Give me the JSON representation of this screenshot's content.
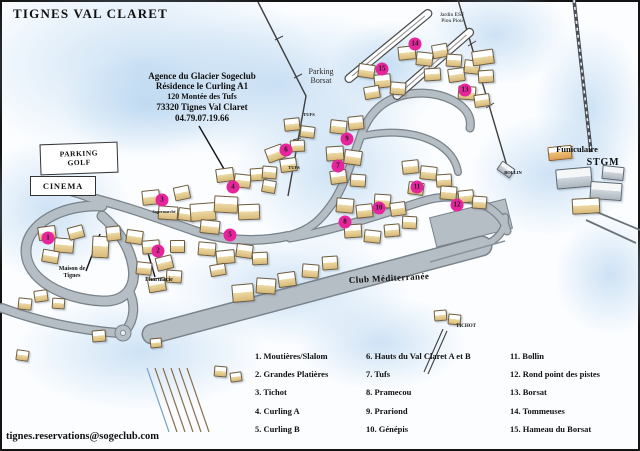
{
  "title": "TIGNES VAL CLARET",
  "agency": {
    "lines": [
      "Agence du Glacier Sogeclub",
      "Résidence le Curling A1",
      "120 Montée des Tufs",
      "73320 Tignes Val Claret",
      "04.79.07.19.66"
    ]
  },
  "contact_email": "tignes.reservations@sogeclub.com",
  "map_labels": {
    "parking_golf": [
      "PARKING",
      "GOLF"
    ],
    "cinema": "CINEMA",
    "parking_borsat": [
      "Parking",
      "Borsat"
    ],
    "jardin_esf": [
      "Jardin ESF",
      "Piou Piou"
    ],
    "funiculaire": "Funiculaire",
    "stgm": "STGM",
    "bollin": "BOLLIN",
    "club_mediterranee": "Club Méditerranée",
    "tichot": "TICHOT",
    "tufs": "TUFS",
    "maison_de_tignes": [
      "Maison de",
      "Tignes"
    ],
    "pharmacie": "Pharmacie",
    "supermarche": "Supermarché"
  },
  "legend": {
    "columns": [
      [
        "1. Moutières/Slalom",
        "2. Grandes Platières",
        "3. Tichot",
        "4. Curling A",
        "5. Curling B"
      ],
      [
        "6. Hauts du Val Claret A et B",
        "7. Tufs",
        "8. Pramecou",
        "9. Prariond",
        "10. Génépis"
      ],
      [
        "11. Bollin",
        "12. Rond point des pistes",
        "13. Borsat",
        "14. Tommeuses",
        "15. Hameau du Borsat"
      ]
    ]
  },
  "markers": [
    {
      "n": "1",
      "x": 48,
      "y": 238
    },
    {
      "n": "2",
      "x": 158,
      "y": 251
    },
    {
      "n": "3",
      "x": 162,
      "y": 200
    },
    {
      "n": "4",
      "x": 233,
      "y": 187
    },
    {
      "n": "5",
      "x": 230,
      "y": 235
    },
    {
      "n": "6",
      "x": 286,
      "y": 150
    },
    {
      "n": "7",
      "x": 338,
      "y": 166
    },
    {
      "n": "8",
      "x": 345,
      "y": 222
    },
    {
      "n": "9",
      "x": 347,
      "y": 139
    },
    {
      "n": "10",
      "x": 379,
      "y": 208
    },
    {
      "n": "11",
      "x": 417,
      "y": 187
    },
    {
      "n": "12",
      "x": 457,
      "y": 205
    },
    {
      "n": "13",
      "x": 465,
      "y": 90
    },
    {
      "n": "14",
      "x": 415,
      "y": 44
    },
    {
      "n": "15",
      "x": 382,
      "y": 69
    }
  ],
  "colors": {
    "marker_pink": "#e6259c",
    "road_gray": "#b6bec5",
    "road_edge": "#79828a",
    "snow_blue": "#a8ccec",
    "ink": "#141414"
  },
  "decor": {
    "snow_patches": [
      [
        -40,
        -30,
        360,
        190
      ],
      [
        120,
        10,
        320,
        150
      ],
      [
        235,
        85,
        200,
        170
      ],
      [
        420,
        -15,
        150,
        100
      ],
      [
        535,
        25,
        110,
        170
      ],
      [
        -30,
        140,
        160,
        140
      ],
      [
        170,
        235,
        240,
        110
      ],
      [
        470,
        115,
        160,
        120
      ],
      [
        15,
        295,
        250,
        115
      ],
      [
        295,
        295,
        170,
        95
      ],
      [
        555,
        215,
        110,
        120
      ],
      [
        60,
        55,
        170,
        100
      ],
      [
        330,
        20,
        120,
        90
      ]
    ],
    "buildings": [
      [
        38,
        226,
        16,
        12,
        -8
      ],
      [
        54,
        238,
        18,
        13,
        5
      ],
      [
        68,
        226,
        14,
        11,
        -15
      ],
      [
        42,
        250,
        15,
        11,
        10
      ],
      [
        92,
        236,
        15,
        20,
        3
      ],
      [
        106,
        226,
        13,
        13,
        -6
      ],
      [
        126,
        230,
        15,
        12,
        8
      ],
      [
        142,
        240,
        16,
        12,
        -5
      ],
      [
        156,
        256,
        15,
        12,
        -14
      ],
      [
        136,
        262,
        14,
        11,
        6
      ],
      [
        170,
        240,
        13,
        11,
        0
      ],
      [
        148,
        278,
        16,
        12,
        -10
      ],
      [
        166,
        270,
        14,
        11,
        4
      ],
      [
        142,
        190,
        16,
        13,
        -6
      ],
      [
        158,
        206,
        18,
        12,
        4
      ],
      [
        174,
        186,
        14,
        12,
        -12
      ],
      [
        178,
        208,
        14,
        11,
        8
      ],
      [
        190,
        203,
        24,
        16,
        -4
      ],
      [
        214,
        196,
        22,
        15,
        3
      ],
      [
        238,
        204,
        20,
        14,
        -2
      ],
      [
        200,
        220,
        18,
        12,
        6
      ],
      [
        216,
        168,
        16,
        12,
        -8
      ],
      [
        234,
        174,
        15,
        12,
        6
      ],
      [
        250,
        168,
        14,
        11,
        -4
      ],
      [
        262,
        180,
        12,
        11,
        10
      ],
      [
        198,
        242,
        16,
        12,
        5
      ],
      [
        216,
        250,
        17,
        12,
        -6
      ],
      [
        236,
        244,
        15,
        12,
        8
      ],
      [
        252,
        252,
        14,
        11,
        -3
      ],
      [
        210,
        264,
        14,
        10,
        -10
      ],
      [
        232,
        284,
        20,
        16,
        -5
      ],
      [
        256,
        278,
        18,
        14,
        4
      ],
      [
        278,
        272,
        16,
        13,
        -8
      ],
      [
        302,
        264,
        15,
        12,
        5
      ],
      [
        322,
        256,
        14,
        12,
        -4
      ],
      [
        18,
        298,
        12,
        10,
        6
      ],
      [
        34,
        290,
        12,
        10,
        -8
      ],
      [
        52,
        298,
        11,
        9,
        4
      ],
      [
        92,
        330,
        12,
        10,
        -5
      ],
      [
        16,
        350,
        11,
        9,
        8
      ],
      [
        150,
        338,
        10,
        8,
        -6
      ],
      [
        214,
        366,
        11,
        9,
        5
      ],
      [
        230,
        372,
        10,
        8,
        -8
      ],
      [
        266,
        146,
        16,
        13,
        -20
      ],
      [
        280,
        158,
        15,
        12,
        -8
      ],
      [
        262,
        166,
        13,
        11,
        5
      ],
      [
        284,
        118,
        14,
        11,
        -6
      ],
      [
        300,
        126,
        13,
        10,
        7
      ],
      [
        290,
        140,
        13,
        10,
        -3
      ],
      [
        330,
        120,
        15,
        12,
        6
      ],
      [
        348,
        116,
        14,
        12,
        -6
      ],
      [
        326,
        146,
        16,
        13,
        -4
      ],
      [
        344,
        150,
        16,
        13,
        8
      ],
      [
        330,
        170,
        15,
        12,
        -8
      ],
      [
        350,
        174,
        14,
        11,
        4
      ],
      [
        336,
        198,
        16,
        13,
        5
      ],
      [
        356,
        204,
        15,
        12,
        -6
      ],
      [
        374,
        194,
        15,
        12,
        4
      ],
      [
        390,
        202,
        14,
        12,
        -8
      ],
      [
        344,
        224,
        16,
        12,
        -4
      ],
      [
        364,
        230,
        15,
        11,
        6
      ],
      [
        384,
        224,
        14,
        11,
        -5
      ],
      [
        402,
        216,
        13,
        11,
        3
      ],
      [
        402,
        160,
        15,
        12,
        -6
      ],
      [
        420,
        166,
        15,
        12,
        6
      ],
      [
        436,
        174,
        14,
        11,
        -4
      ],
      [
        408,
        182,
        14,
        11,
        8
      ],
      [
        440,
        186,
        15,
        12,
        5
      ],
      [
        458,
        190,
        14,
        11,
        -6
      ],
      [
        472,
        196,
        13,
        11,
        4
      ],
      [
        448,
        68,
        15,
        12,
        -8
      ],
      [
        464,
        60,
        14,
        12,
        6
      ],
      [
        478,
        70,
        14,
        11,
        -4
      ],
      [
        458,
        86,
        16,
        12,
        4
      ],
      [
        474,
        94,
        14,
        11,
        -8
      ],
      [
        398,
        46,
        16,
        12,
        -6
      ],
      [
        416,
        52,
        15,
        12,
        6
      ],
      [
        432,
        44,
        14,
        12,
        -10
      ],
      [
        446,
        54,
        14,
        11,
        4
      ],
      [
        424,
        68,
        15,
        11,
        -4
      ],
      [
        358,
        64,
        15,
        12,
        8
      ],
      [
        374,
        74,
        15,
        12,
        -6
      ],
      [
        390,
        82,
        14,
        11,
        5
      ],
      [
        364,
        86,
        14,
        11,
        -10
      ],
      [
        472,
        50,
        20,
        13,
        -8
      ],
      [
        548,
        146,
        22,
        12,
        -6,
        "o"
      ],
      [
        556,
        168,
        34,
        18,
        -5,
        "g"
      ],
      [
        590,
        182,
        30,
        16,
        4,
        "g"
      ],
      [
        572,
        198,
        26,
        14,
        -3
      ],
      [
        602,
        166,
        20,
        12,
        6,
        "g"
      ],
      [
        434,
        310,
        11,
        9,
        -5
      ],
      [
        448,
        314,
        11,
        9,
        6
      ],
      [
        498,
        164,
        14,
        9,
        35,
        "g"
      ]
    ]
  }
}
